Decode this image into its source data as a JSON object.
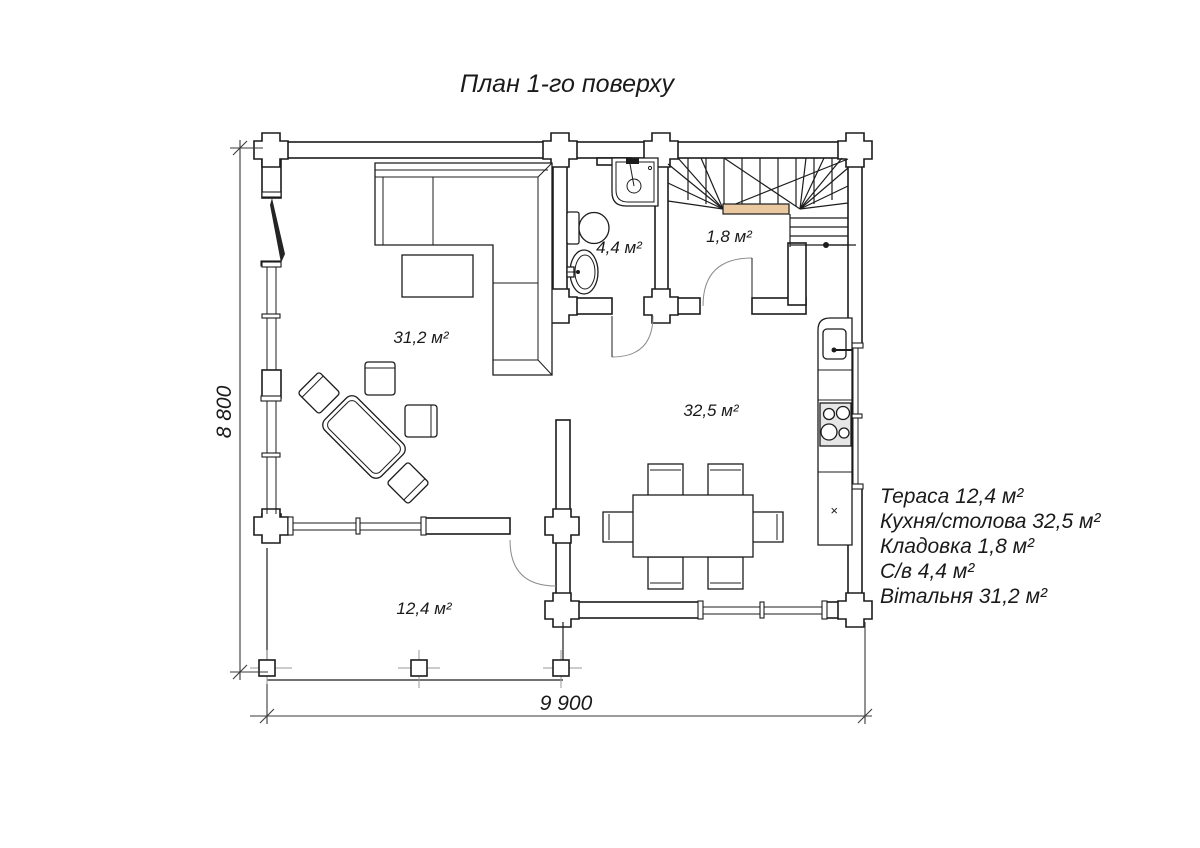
{
  "title": "План 1-го поверху",
  "dimensions": {
    "width_label": "9 900",
    "height_label": "8 800"
  },
  "rooms": {
    "living": "31,2 м²",
    "bathroom": "4,4 м²",
    "storage": "1,8 м²",
    "kitchen": "32,5 м²",
    "terrace": "12,4 м²"
  },
  "legend": {
    "lines": [
      "Тераса 12,4 м²",
      "Кухня/столова 32,5 м²",
      "Кладовка 1,8 м²",
      "С/в 4,4 м²",
      "Вітальня 31,2 м²"
    ]
  },
  "markers": {
    "cabinet_mark": "×"
  },
  "colors": {
    "line": "#1c1c1c",
    "stair_landing": "#eac9a0",
    "stove_fill": "#e6e6e6"
  }
}
